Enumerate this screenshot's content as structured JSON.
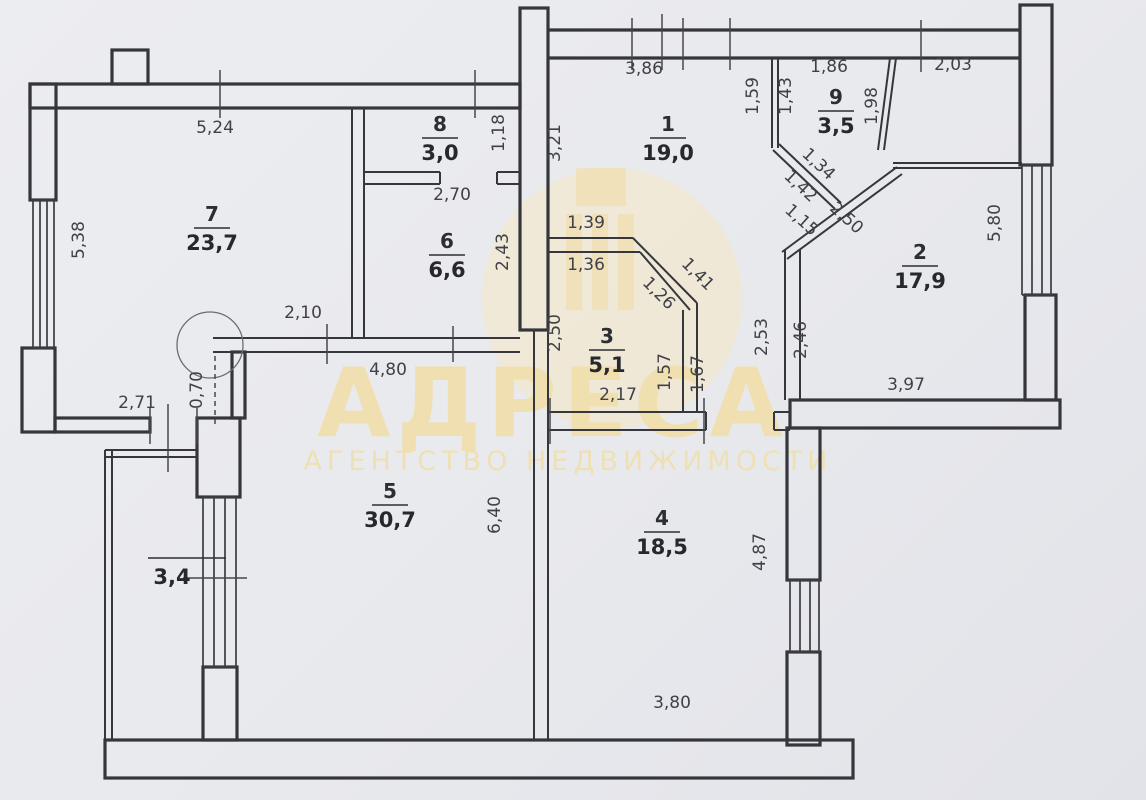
{
  "watermark": {
    "brand": "АДРЕСА",
    "subtitle": "АГЕНТСТВО НЕДВИЖИМОСТИ"
  },
  "rooms": [
    {
      "number": "1",
      "area": "19,0"
    },
    {
      "number": "2",
      "area": "17,9"
    },
    {
      "number": "3",
      "area": "5,1"
    },
    {
      "number": "4",
      "area": "18,5"
    },
    {
      "number": "5",
      "area": "30,7"
    },
    {
      "number": "6",
      "area": "6,6"
    },
    {
      "number": "7",
      "area": "23,7"
    },
    {
      "number": "8",
      "area": "3,0"
    },
    {
      "number": "9",
      "area": "3,5"
    }
  ],
  "balcony": {
    "area": "3,4"
  },
  "dims": {
    "room7_top": "5,24",
    "room7_left": "5,38",
    "room7_bottom": "2,10",
    "entry_wall": "2,71",
    "corner_step": "0,70",
    "room5_top": "4,80",
    "room5_right": "6,40",
    "room4_bottom": "3,80",
    "room4_right": "4,87",
    "room2_bottom": "3,97",
    "room2_right": "5,80",
    "room1_top": "3,86",
    "room1_left": "3,21",
    "room8_right": "1,18",
    "room8_bottom": "2,70",
    "room6_right": "2,43",
    "room3_left": "2,50",
    "room3_top_outer": "1,39",
    "room3_top_inner": "1,36",
    "room3_diag_outer": "1,41",
    "room3_diag_inner": "1,26",
    "room3_right_inner": "1,57",
    "room3_right_outer": "1,67",
    "room3_bottom": "2,17",
    "hall_wall": "2,53",
    "room2_left": "2,46",
    "room9_left_outer": "1,59",
    "room9_left_inner": "1,43",
    "room9_top": "1,86",
    "niche_top": "2,03",
    "room9_right": "1,98",
    "room9_diag_upper": "1,34",
    "room9_diag_lower": "1,42",
    "chamfer_short": "1,15",
    "chamfer_long": "2,50"
  },
  "colors": {
    "background": "#e8e9ed",
    "walls": "#35373c",
    "watermark": "#f0dca6"
  }
}
